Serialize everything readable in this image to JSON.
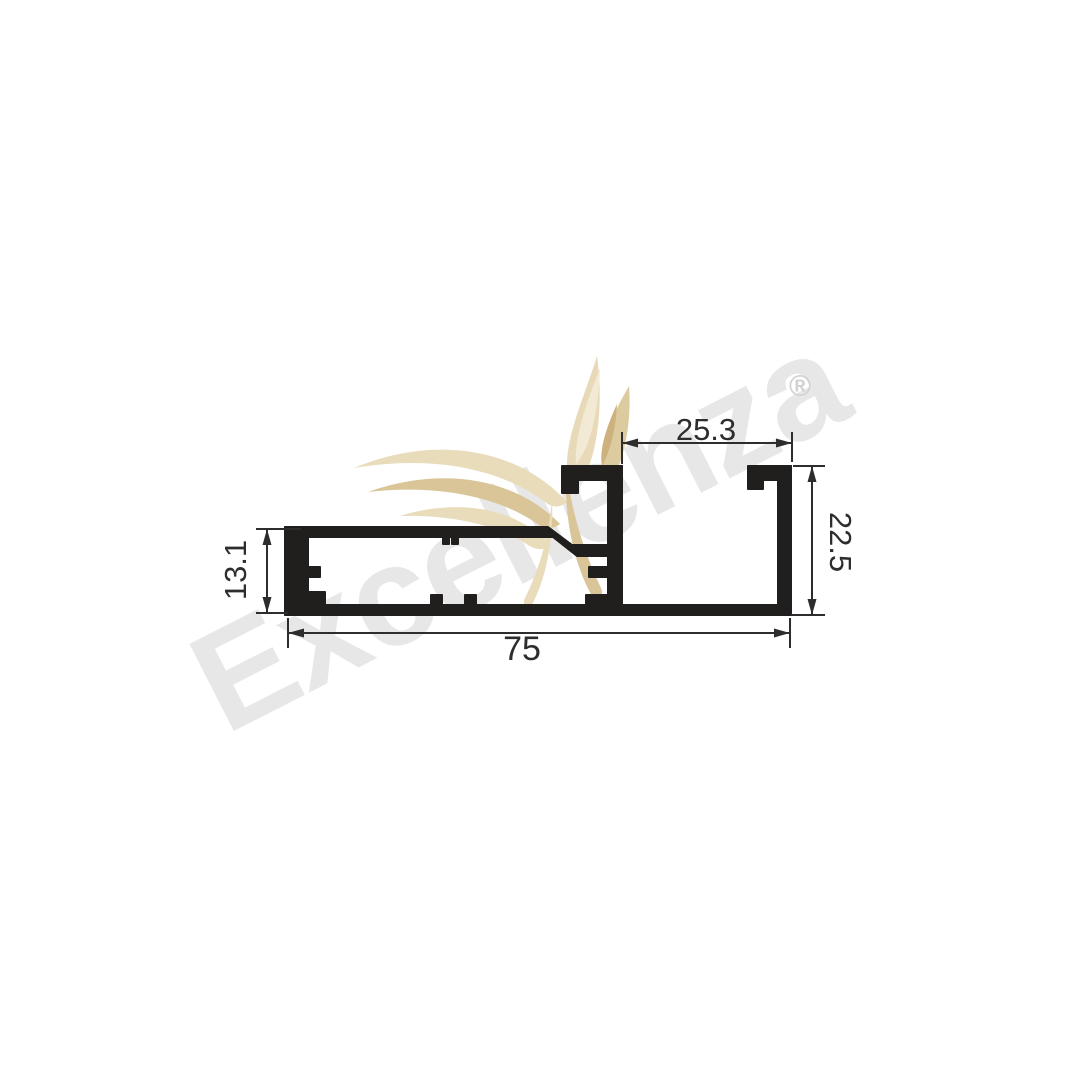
{
  "watermark": {
    "brand_text": "Excellenza",
    "registered_symbol": "®"
  },
  "drawing": {
    "type": "aluminum-extrusion-profile-cross-section",
    "dimensions": {
      "opening_top": {
        "value": "25.3",
        "orientation": "horizontal",
        "position": "top-right"
      },
      "right_height": {
        "value": "22.5",
        "orientation": "vertical",
        "position": "right"
      },
      "left_height": {
        "value": "13.1",
        "orientation": "vertical",
        "position": "left"
      },
      "total_width": {
        "value": "75",
        "orientation": "horizontal",
        "position": "bottom"
      }
    },
    "colors": {
      "profile_fill": "#211e1e",
      "dimension_lines": "#2e2c2c",
      "watermark_gray": "#e7e7e7",
      "wing_beige_light": "#e9dcbb",
      "wing_beige_mid": "#d9c597",
      "wing_beige_dark": "#cdb27e"
    }
  }
}
